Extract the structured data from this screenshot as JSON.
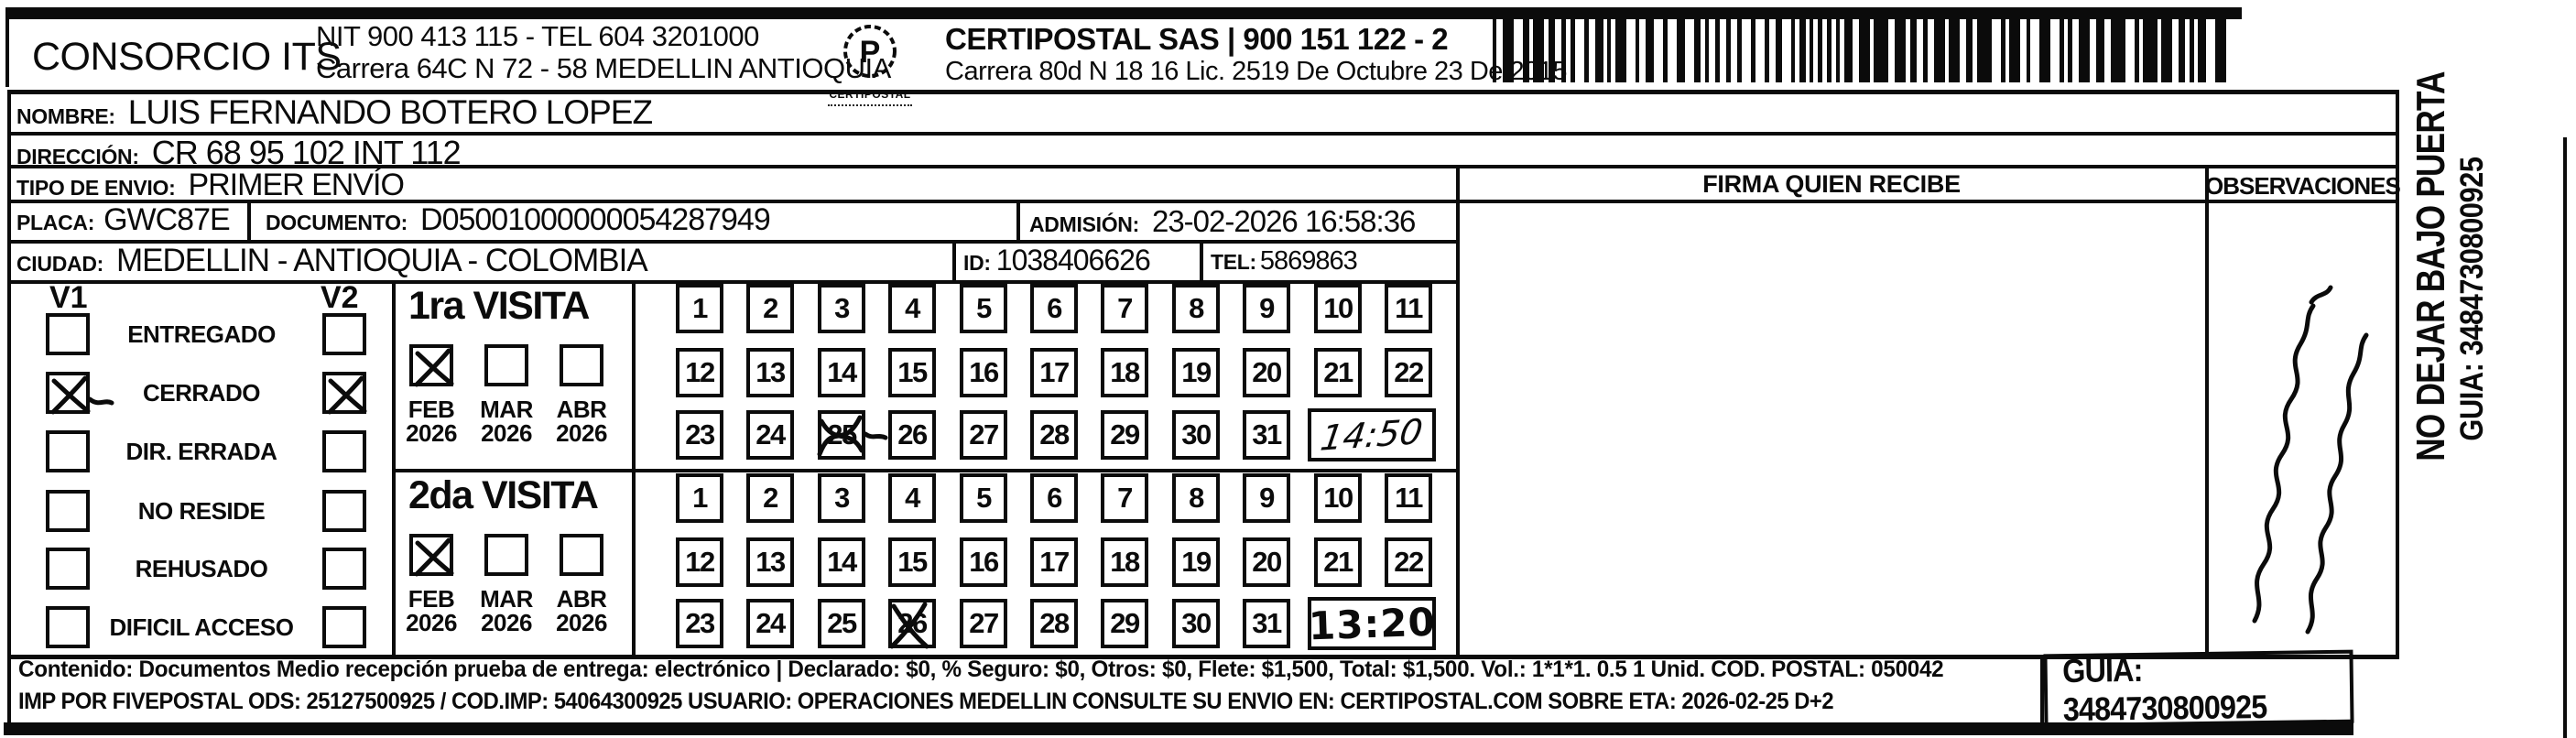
{
  "colors": {
    "ink": "#0b0b0b",
    "paper": "#ffffff"
  },
  "header": {
    "company": "CONSORCIO ITS",
    "nit_line": "NIT 900 413 115 - TEL 604 3201000",
    "address_line": "Carrera 64C N 72 - 58 MEDELLIN ANTIOQUIA",
    "logo_text": "CERTIPOSTAL",
    "certipostal_line": "CERTIPOSTAL SAS | 900 151 122 - 2",
    "certipostal_address": "Carrera 80d N 18 16  Lic. 2519 De Octubre 23 De 2015"
  },
  "form": {
    "nombre_label": "NOMBRE:",
    "nombre": "LUIS FERNANDO BOTERO LOPEZ",
    "direccion_label": "DIRECCIÓN:",
    "direccion": "CR 68 95 102 INT 112",
    "tipo_label": "TIPO DE ENVIO:",
    "tipo": "PRIMER ENVÍO",
    "placa_label": "PLACA:",
    "placa": "GWC87E",
    "documento_label": "DOCUMENTO:",
    "documento": "D05001000000054287949",
    "admision_label": "ADMISIÓN:",
    "admision": "23-02-2026 16:58:36",
    "ciudad_label": "CIUDAD:",
    "ciudad": "MEDELLIN - ANTIOQUIA - COLOMBIA",
    "id_label": "ID:",
    "id": "1038406626",
    "tel_label": "TEL:",
    "tel": "5869863"
  },
  "firma_header": "FIRMA QUIEN RECIBE",
  "observaciones_header": "OBSERVACIONES",
  "observaciones_note": "(illegible handwriting)",
  "status": {
    "v1": "V1",
    "v2": "V2",
    "options": [
      {
        "label": "ENTREGADO",
        "v1": false,
        "v2": false
      },
      {
        "label": "CERRADO",
        "v1": true,
        "v2": true
      },
      {
        "label": "DIR. ERRADA",
        "v1": false,
        "v2": false
      },
      {
        "label": "NO RESIDE",
        "v1": false,
        "v2": false
      },
      {
        "label": "REHUSADO",
        "v1": false,
        "v2": false
      },
      {
        "label": "DIFICIL ACCESO",
        "v1": false,
        "v2": false
      }
    ]
  },
  "visits": [
    {
      "title": "1ra VISITA",
      "months": [
        {
          "label": "FEB",
          "year": "2026",
          "checked": true
        },
        {
          "label": "MAR",
          "year": "2026",
          "checked": false
        },
        {
          "label": "ABR",
          "year": "2026",
          "checked": false
        }
      ],
      "day_rows": [
        [
          1,
          2,
          3,
          4,
          5,
          6,
          7,
          8,
          9,
          10,
          11
        ],
        [
          12,
          13,
          14,
          15,
          16,
          17,
          18,
          19,
          20,
          21,
          22
        ],
        [
          23,
          24,
          25,
          26,
          27,
          28,
          29,
          30,
          31
        ]
      ],
      "crossed_day": 25,
      "time_written": "14:50"
    },
    {
      "title": "2da VISITA",
      "months": [
        {
          "label": "FEB",
          "year": "2026",
          "checked": true
        },
        {
          "label": "MAR",
          "year": "2026",
          "checked": false
        },
        {
          "label": "ABR",
          "year": "2026",
          "checked": false
        }
      ],
      "day_rows": [
        [
          1,
          2,
          3,
          4,
          5,
          6,
          7,
          8,
          9,
          10,
          11
        ],
        [
          12,
          13,
          14,
          15,
          16,
          17,
          18,
          19,
          20,
          21,
          22
        ],
        [
          23,
          24,
          25,
          26,
          27,
          28,
          29,
          30,
          31
        ]
      ],
      "crossed_day": 26,
      "time_written": "13:20"
    }
  ],
  "side_label": {
    "line1": "NO DEJAR BAJO PUERTA",
    "line2": "GUIA: 3484730800925"
  },
  "footer": {
    "line1": "Contenido: Documentos Medio recepción prueba de entrega: electrónico | Declarado: $0, % Seguro: $0, Otros: $0, Flete: $1,500, Total: $1,500. Vol.: 1*1*1. 0.5 1 Unid. COD. POSTAL: 050042",
    "line2": "IMP POR FIVEPOSTAL ODS: 25127500925 / COD.IMP: 54064300925 USUARIO: OPERACIONES MEDELLIN CONSULTE SU ENVIO EN: CERTIPOSTAL.COM SOBRE ETA: 2026-02-25 D+2",
    "guia": "GUIA: 3484730800925"
  }
}
